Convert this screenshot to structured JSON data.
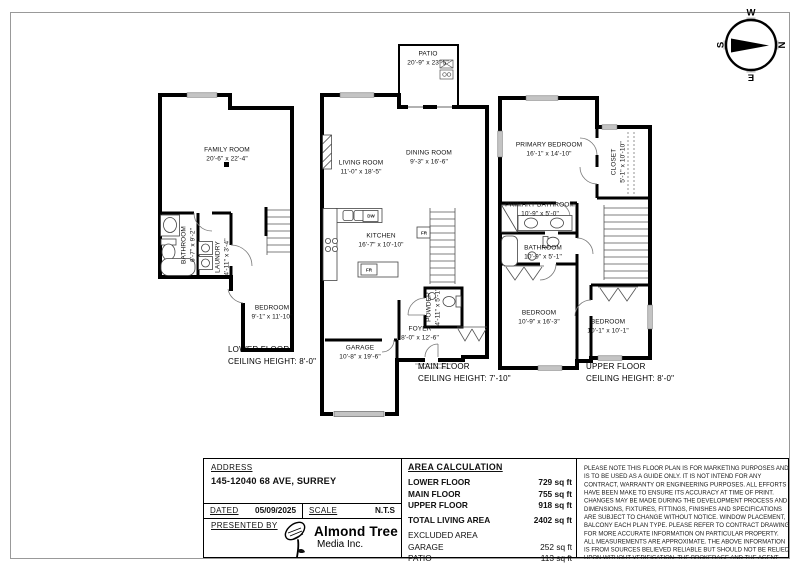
{
  "compass": {
    "w": "W",
    "n": "N",
    "e": "E",
    "s": "S"
  },
  "floors": {
    "lower": {
      "title": "LOWER FLOOR\nCEILING HEIGHT: 8'-0\"",
      "rooms": {
        "family_room": "FAMILY ROOM\n20'-6\" x 22'-4\"",
        "bathroom": "BATHROOM\n6'-7\" x 9'-2\"",
        "laundry": "LAUNDRY\n4'-11\" x 3'-4\"",
        "bedroom": "BEDROOM\n9'-1\" x 11'-10\""
      }
    },
    "main": {
      "title": "MAIN FLOOR\nCEILING HEIGHT: 7'-10\"",
      "rooms": {
        "patio": "PATIO\n20'-9\" x 23'-5\"",
        "living_room": "LIVING ROOM\n11'-0\" x 18'-5\"",
        "dining_room": "DINING ROOM\n9'-3\" x 16'-6\"",
        "kitchen": "KITCHEN\n16'-7\" x 10'-10\"",
        "powder": "POWDER\n4'-11\" x 5'-1\"",
        "foyer": "FOYER\n8'-0\" x 12'-6\"",
        "garage": "GARAGE\n10'-8\" x 19'-6\""
      },
      "appliances": {
        "dishwasher": "DW",
        "fridge": "FR",
        "fridge2": "FR"
      }
    },
    "upper": {
      "title": "UPPER FLOOR\nCEILING HEIGHT: 8'-0\"",
      "rooms": {
        "primary_bedroom": "PRIMARY BEDROOM\n16'-1\" x 14'-10\"",
        "closet": "CLOSET\n5'-1\" x 10'-10\"",
        "primary_bathroom": "PRIMARY BATHROOM\n10'-9\" x 5'-0\"",
        "bathroom": "BATHROOM\n10'-9\" x 5'-1\"",
        "bedroom_left": "BEDROOM\n10'-9\" x 16'-3\"",
        "bedroom_right": "BEDROOM\n10'-1\" x 10'-1\""
      }
    }
  },
  "title_block": {
    "address_label": "ADDRESS",
    "address_value": "145-12040 68 AVE, SURREY",
    "dated_label": "DATED",
    "dated_value": "05/09/2025",
    "scale_label": "SCALE",
    "scale_value": "N.T.S",
    "presented_by_label": "PRESENTED BY",
    "logo": {
      "name": "Almond Tree",
      "sub": "Media Inc."
    },
    "area": {
      "header": "AREA CALCULATION",
      "rows": [
        {
          "label": "LOWER FLOOR",
          "value": "729 sq ft"
        },
        {
          "label": "MAIN FLOOR",
          "value": "755 sq ft"
        },
        {
          "label": "UPPER FLOOR",
          "value": "918 sq ft"
        },
        {
          "label": "TOTAL LIVING AREA",
          "value": "2402 sq ft"
        },
        {
          "label": "EXCLUDED AREA",
          "value": ""
        },
        {
          "label": "GARAGE",
          "value": "252 sq ft"
        },
        {
          "label": "PATIO",
          "value": "113 sq ft"
        }
      ]
    },
    "disclaimer": "PLEASE NOTE THIS FLOOR PLAN IS FOR MARKETING PURPOSES AND IS TO BE USED AS A GUIDE ONLY. IT IS NOT INTEND FOR ANY CONTRACT, WARRANTY OR ENGINEERING PURPOSES. ALL EFFORTS HAVE BEEN MAKE TO ENSURE ITS ACCURACY AT TIME OF PRINT. CHANGES MAY BE MADE DURING THE DEVELOPMENT PROCESS AND DIMENSIONS, FIXTURES, FITTINGS, FINISHES AND SPECIFICATIONS ARE SUBJECT TO CHANGE WITHOUT NOTICE. WINDOW PLACEMENT, BALCONY EACH PLAN TYPE. PLEASE REFER TO CONTRACT DRAWING FOR MORE ACCURATE INFORMATION ON PARTICULAR PROPERTY. ALL MEASUREMENTS ARE APPROXIMATE. THE ABOVE INFORMATION IS FROM SOURCES BELIEVED RELIABLE BUT SHOULD NOT BE RELIED UPON WITHOUT VERIFICATION. THE BROKERAGE AND THE AGENT ASSUME NO RESPONSIBILITY FOR ITS ACCURACY"
  }
}
